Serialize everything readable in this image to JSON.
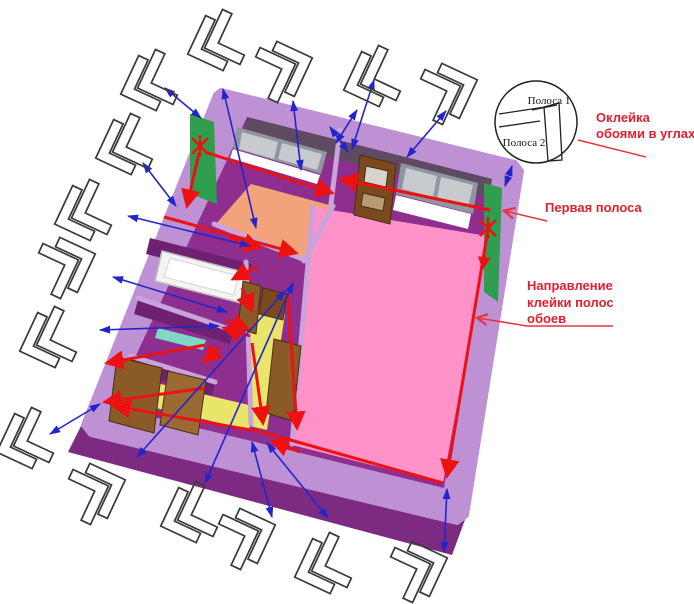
{
  "diagram": {
    "callout": {
      "strip1": "Полоса 1",
      "strip2": "Полоса 2"
    },
    "labels": {
      "corner_gluing": {
        "line1": "Оклейка",
        "line2": "обоями в углах"
      },
      "first_strip": "Первая полоса",
      "direction": {
        "line1": "Направление",
        "line2": "клейки полос",
        "line3": "обоев"
      }
    },
    "colors": {
      "label_red": "#e31f2f",
      "leader_red": "#e8333f",
      "arrow_red": "#ed1111",
      "arrow_blue": "#2424cc",
      "glyph_black": "#3a3a3a",
      "slab_light": "#be90d4",
      "slab_dark": "#7d2b82",
      "wall_magenta": "#8e2f90",
      "wall_shadow": "#5f4b61",
      "wall_dark_face": "#6e2170",
      "wall_top_light": "#c9a3dc",
      "floor_pink": "#ff92c8",
      "floor_salmon": "#f2a37c",
      "floor_yellow": "#e9e46a",
      "strip_green": "#2f9e4f",
      "door_brown": "#8a5a28",
      "door_brown_dark": "#7a4a1e",
      "window_gray": "#9096a0",
      "window_pane": "#c7cbcd",
      "tub_white": "#f4f4f4",
      "shelf_teal": "#7fd8c3"
    }
  }
}
